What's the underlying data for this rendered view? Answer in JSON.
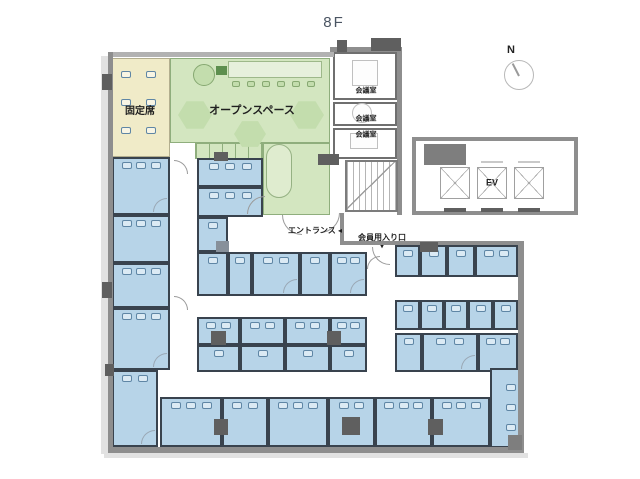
{
  "title": "8F",
  "compass": {
    "label": "N"
  },
  "colors": {
    "room_blue": "#b7d4e8",
    "wall_dark": "#39434e",
    "room_green": "#d3e6c0",
    "green_line": "#8fae7d",
    "room_yellow": "#f0ebc8",
    "yellow_line": "#b3ae8e",
    "wall_gray": "#8e8e8e",
    "shadow": "#e2e2e2",
    "text": "#1f1f1f"
  },
  "labels": [
    {
      "text": "固定席",
      "x": 140,
      "y": 112,
      "s": 10
    },
    {
      "text": "オープンスペース",
      "x": 252,
      "y": 111,
      "s": 11
    },
    {
      "text": "会議室",
      "x": 366,
      "y": 91,
      "s": 7
    },
    {
      "text": "会議室",
      "x": 366,
      "y": 119,
      "s": 7
    },
    {
      "text": "会議室",
      "x": 366,
      "y": 135,
      "s": 7
    },
    {
      "text": "EV",
      "x": 492,
      "y": 183,
      "s": 9
    },
    {
      "text": "エントランス ◂",
      "x": 315,
      "y": 231,
      "s": 8
    },
    {
      "text": "会員用入り口",
      "x": 382,
      "y": 238,
      "s": 8
    },
    {
      "text": "▾",
      "x": 382,
      "y": 247,
      "s": 7
    }
  ],
  "rooms": [
    {
      "name": "fixed-seats-room",
      "type": "yellow",
      "x": 112,
      "y": 58,
      "w": 58,
      "h": 99,
      "desks": 6,
      "side": "grid"
    },
    {
      "name": "open-space-main",
      "type": "green",
      "x": 170,
      "y": 58,
      "w": 160,
      "h": 85
    },
    {
      "name": "open-space-stalls",
      "type": "green",
      "x": 195,
      "y": 143,
      "w": 68,
      "h": 16,
      "stripes": true
    },
    {
      "name": "open-space-side",
      "type": "green",
      "x": 263,
      "y": 143,
      "w": 67,
      "h": 72
    },
    {
      "name": "meeting-room-1",
      "type": "white",
      "x": 333,
      "y": 52,
      "w": 64,
      "h": 48
    },
    {
      "name": "meeting-room-2",
      "type": "white",
      "x": 333,
      "y": 102,
      "w": 64,
      "h": 24
    },
    {
      "name": "meeting-room-3",
      "type": "white",
      "x": 333,
      "y": 128,
      "w": 64,
      "h": 31
    },
    {
      "name": "office-room",
      "type": "blue",
      "x": 112,
      "y": 157,
      "w": 58,
      "h": 58,
      "desks": 3,
      "door": true
    },
    {
      "name": "office-room",
      "type": "blue",
      "x": 112,
      "y": 215,
      "w": 58,
      "h": 48,
      "desks": 3
    },
    {
      "name": "office-room",
      "type": "blue",
      "x": 112,
      "y": 263,
      "w": 58,
      "h": 45,
      "desks": 3
    },
    {
      "name": "office-room",
      "type": "blue",
      "x": 112,
      "y": 308,
      "w": 58,
      "h": 62,
      "desks": 3,
      "door": true
    },
    {
      "name": "office-room",
      "type": "blue",
      "x": 112,
      "y": 370,
      "w": 46,
      "h": 77,
      "desks": 2,
      "door": true
    },
    {
      "name": "office-room",
      "type": "blue",
      "x": 197,
      "y": 158,
      "w": 66,
      "h": 29,
      "desks": 3
    },
    {
      "name": "office-room",
      "type": "blue",
      "x": 197,
      "y": 187,
      "w": 66,
      "h": 30,
      "desks": 3
    },
    {
      "name": "office-room",
      "type": "blue",
      "x": 197,
      "y": 217,
      "w": 31,
      "h": 35,
      "desks": 1
    },
    {
      "name": "office-room",
      "type": "blue",
      "x": 197,
      "y": 252,
      "w": 31,
      "h": 44,
      "desks": 1
    },
    {
      "name": "office-room",
      "type": "blue",
      "x": 228,
      "y": 252,
      "w": 24,
      "h": 44,
      "desks": 1
    },
    {
      "name": "office-room",
      "type": "blue",
      "x": 252,
      "y": 252,
      "w": 48,
      "h": 44,
      "desks": 2,
      "door": true
    },
    {
      "name": "office-room",
      "type": "blue",
      "x": 300,
      "y": 252,
      "w": 30,
      "h": 44,
      "desks": 1
    },
    {
      "name": "office-room",
      "type": "blue",
      "x": 330,
      "y": 252,
      "w": 37,
      "h": 44,
      "desks": 2,
      "door": true
    },
    {
      "name": "office-room",
      "type": "blue",
      "x": 395,
      "y": 245,
      "w": 25,
      "h": 32,
      "desks": 1
    },
    {
      "name": "office-room",
      "type": "blue",
      "x": 420,
      "y": 245,
      "w": 27,
      "h": 32,
      "desks": 1
    },
    {
      "name": "office-room",
      "type": "blue",
      "x": 447,
      "y": 245,
      "w": 28,
      "h": 32,
      "desks": 1
    },
    {
      "name": "office-room",
      "type": "blue",
      "x": 475,
      "y": 245,
      "w": 43,
      "h": 32,
      "desks": 2
    },
    {
      "name": "office-room",
      "type": "blue",
      "x": 197,
      "y": 317,
      "w": 43,
      "h": 28,
      "desks": 2
    },
    {
      "name": "office-room",
      "type": "blue",
      "x": 240,
      "y": 317,
      "w": 45,
      "h": 28,
      "desks": 2
    },
    {
      "name": "office-room",
      "type": "blue",
      "x": 285,
      "y": 317,
      "w": 45,
      "h": 28,
      "desks": 2
    },
    {
      "name": "office-room",
      "type": "blue",
      "x": 330,
      "y": 317,
      "w": 37,
      "h": 28,
      "desks": 2
    },
    {
      "name": "booth",
      "type": "blue",
      "x": 197,
      "y": 345,
      "w": 43,
      "h": 27,
      "desks": 1
    },
    {
      "name": "booth",
      "type": "blue",
      "x": 240,
      "y": 345,
      "w": 45,
      "h": 27,
      "desks": 1
    },
    {
      "name": "booth",
      "type": "blue",
      "x": 285,
      "y": 345,
      "w": 45,
      "h": 27,
      "desks": 1
    },
    {
      "name": "booth",
      "type": "blue",
      "x": 330,
      "y": 345,
      "w": 37,
      "h": 27,
      "desks": 1
    },
    {
      "name": "booth",
      "type": "blue",
      "x": 395,
      "y": 300,
      "w": 25,
      "h": 30,
      "desks": 1
    },
    {
      "name": "booth",
      "type": "blue",
      "x": 420,
      "y": 300,
      "w": 24,
      "h": 30,
      "desks": 1
    },
    {
      "name": "booth",
      "type": "blue",
      "x": 444,
      "y": 300,
      "w": 24,
      "h": 30,
      "desks": 1
    },
    {
      "name": "booth",
      "type": "blue",
      "x": 468,
      "y": 300,
      "w": 25,
      "h": 30,
      "desks": 1
    },
    {
      "name": "booth",
      "type": "blue",
      "x": 493,
      "y": 300,
      "w": 25,
      "h": 30,
      "desks": 1
    },
    {
      "name": "office-room",
      "type": "blue",
      "x": 395,
      "y": 333,
      "w": 27,
      "h": 39,
      "desks": 1
    },
    {
      "name": "office-room",
      "type": "blue",
      "x": 422,
      "y": 333,
      "w": 56,
      "h": 39,
      "desks": 2,
      "door": true
    },
    {
      "name": "office-room",
      "type": "blue",
      "x": 478,
      "y": 333,
      "w": 40,
      "h": 39,
      "desks": 2
    },
    {
      "name": "office-room",
      "type": "blue",
      "x": 160,
      "y": 397,
      "w": 62,
      "h": 50,
      "desks": 3
    },
    {
      "name": "office-room",
      "type": "blue",
      "x": 222,
      "y": 397,
      "w": 46,
      "h": 50,
      "desks": 2
    },
    {
      "name": "office-room",
      "type": "blue",
      "x": 268,
      "y": 397,
      "w": 60,
      "h": 50,
      "desks": 3
    },
    {
      "name": "office-room",
      "type": "blue",
      "x": 328,
      "y": 397,
      "w": 47,
      "h": 50,
      "desks": 2
    },
    {
      "name": "office-room",
      "type": "blue",
      "x": 375,
      "y": 397,
      "w": 57,
      "h": 50,
      "desks": 3
    },
    {
      "name": "office-room",
      "type": "blue",
      "x": 432,
      "y": 397,
      "w": 58,
      "h": 50,
      "desks": 3
    },
    {
      "name": "office-room",
      "type": "blue",
      "x": 490,
      "y": 368,
      "w": 30,
      "h": 80,
      "desks": 3,
      "side": "right"
    }
  ],
  "shadows": [
    {
      "x": 101,
      "y": 56,
      "w": 7,
      "h": 398
    },
    {
      "x": 104,
      "y": 453,
      "w": 424,
      "h": 5
    }
  ],
  "walls": [
    {
      "x": 108,
      "y": 52,
      "w": 226,
      "h": 5,
      "c": "#b2b2b2"
    },
    {
      "x": 330,
      "y": 47,
      "w": 72,
      "h": 5
    },
    {
      "x": 108,
      "y": 52,
      "w": 5,
      "h": 400
    },
    {
      "x": 108,
      "y": 447,
      "w": 416,
      "h": 6
    },
    {
      "x": 518,
      "y": 241,
      "w": 6,
      "h": 210
    },
    {
      "x": 340,
      "y": 241,
      "w": 184,
      "h": 4
    },
    {
      "x": 397,
      "y": 47,
      "w": 5,
      "h": 168
    },
    {
      "x": 340,
      "y": 213,
      "w": 4,
      "h": 32
    },
    {
      "x": 412,
      "y": 137,
      "w": 166,
      "h": 4
    },
    {
      "x": 574,
      "y": 137,
      "w": 4,
      "h": 78
    },
    {
      "x": 412,
      "y": 211,
      "w": 166,
      "h": 4
    },
    {
      "x": 412,
      "y": 137,
      "w": 4,
      "h": 78
    },
    {
      "x": 444,
      "y": 161,
      "w": 22,
      "h": 2,
      "c": "#c9c9c9"
    },
    {
      "x": 481,
      "y": 161,
      "w": 22,
      "h": 2,
      "c": "#c9c9c9"
    },
    {
      "x": 518,
      "y": 161,
      "w": 22,
      "h": 2,
      "c": "#c9c9c9"
    }
  ],
  "blocks": [
    {
      "x": 102,
      "y": 74,
      "w": 10,
      "h": 16
    },
    {
      "x": 102,
      "y": 282,
      "w": 10,
      "h": 16
    },
    {
      "x": 105,
      "y": 364,
      "w": 9,
      "h": 12
    },
    {
      "x": 214,
      "y": 152,
      "w": 14,
      "h": 9
    },
    {
      "x": 318,
      "y": 154,
      "w": 21,
      "h": 11
    },
    {
      "x": 337,
      "y": 40,
      "w": 10,
      "h": 12
    },
    {
      "x": 371,
      "y": 38,
      "w": 30,
      "h": 13
    },
    {
      "x": 424,
      "y": 144,
      "w": 42,
      "h": 21,
      "c": "#7e7e7e"
    },
    {
      "x": 420,
      "y": 242,
      "w": 18,
      "h": 10
    },
    {
      "x": 216,
      "y": 241,
      "w": 13,
      "h": 11,
      "c": "#87909a"
    },
    {
      "x": 211,
      "y": 331,
      "w": 15,
      "h": 14
    },
    {
      "x": 327,
      "y": 331,
      "w": 14,
      "h": 14
    },
    {
      "x": 214,
      "y": 419,
      "w": 14,
      "h": 16
    },
    {
      "x": 342,
      "y": 417,
      "w": 18,
      "h": 18
    },
    {
      "x": 428,
      "y": 419,
      "w": 15,
      "h": 16
    },
    {
      "x": 508,
      "y": 435,
      "w": 14,
      "h": 15,
      "c": "#7e7e7e"
    },
    {
      "x": 444,
      "y": 208,
      "w": 22,
      "h": 4
    },
    {
      "x": 481,
      "y": 208,
      "w": 22,
      "h": 4
    },
    {
      "x": 518,
      "y": 208,
      "w": 22,
      "h": 4
    }
  ],
  "furniture": [
    {
      "type": "circle",
      "x": 193,
      "y": 64,
      "w": 22,
      "h": 22,
      "fill": "#c3ddad",
      "stroke": "#86a871"
    },
    {
      "type": "rect",
      "x": 216,
      "y": 66,
      "w": 11,
      "h": 9,
      "fill": "#5d8f4e"
    },
    {
      "type": "rect",
      "x": 228,
      "y": 61,
      "w": 94,
      "h": 17,
      "fill": "#e6f0dc",
      "stroke": "#9db88a"
    },
    {
      "type": "stools",
      "x": 232,
      "y": 81,
      "n": 6,
      "gap": 15,
      "fill": "#c3ddad",
      "stroke": "#86a871"
    },
    {
      "type": "hex",
      "x": 178,
      "y": 100,
      "w": 34,
      "h": 30,
      "fill": "#c3ddad"
    },
    {
      "type": "hex",
      "x": 234,
      "y": 120,
      "w": 32,
      "h": 28,
      "fill": "#c3ddad"
    },
    {
      "type": "hex",
      "x": 290,
      "y": 100,
      "w": 34,
      "h": 30,
      "fill": "#c3ddad"
    },
    {
      "type": "oval",
      "x": 266,
      "y": 144,
      "w": 26,
      "h": 54,
      "fill": "#dfeccf",
      "stroke": "#95b183"
    },
    {
      "type": "rect",
      "x": 352,
      "y": 60,
      "w": 26,
      "h": 26,
      "fill": "#fdfdfd",
      "stroke": "#c0c0c0"
    },
    {
      "type": "circle",
      "x": 352,
      "y": 103,
      "w": 20,
      "h": 20,
      "fill": "#fdfdfd",
      "stroke": "#c0c0c0"
    },
    {
      "type": "rect",
      "x": 350,
      "y": 133,
      "w": 28,
      "h": 16,
      "fill": "#fdfdfd",
      "stroke": "#c0c0c0"
    }
  ],
  "stairs": {
    "x": 345,
    "y": 160,
    "w": 53,
    "h": 52
  },
  "elevator": {
    "shafts": [
      {
        "x": 440,
        "y": 167,
        "w": 30,
        "h": 32
      },
      {
        "x": 477,
        "y": 167,
        "w": 30,
        "h": 32
      },
      {
        "x": 514,
        "y": 167,
        "w": 30,
        "h": 32
      }
    ]
  },
  "doors": [
    {
      "x": 247,
      "y": 196,
      "r": 18,
      "c": "tl"
    },
    {
      "x": 282,
      "y": 215,
      "r": 20,
      "c": "bl"
    },
    {
      "x": 320,
      "y": 213,
      "r": 20,
      "c": "br"
    },
    {
      "x": 372,
      "y": 247,
      "r": 18,
      "c": "bl"
    },
    {
      "x": 174,
      "y": 160,
      "r": 14,
      "c": "tr"
    },
    {
      "x": 174,
      "y": 296,
      "r": 14,
      "c": "tr"
    },
    {
      "x": 367,
      "y": 256,
      "r": 13,
      "c": "tl"
    }
  ]
}
